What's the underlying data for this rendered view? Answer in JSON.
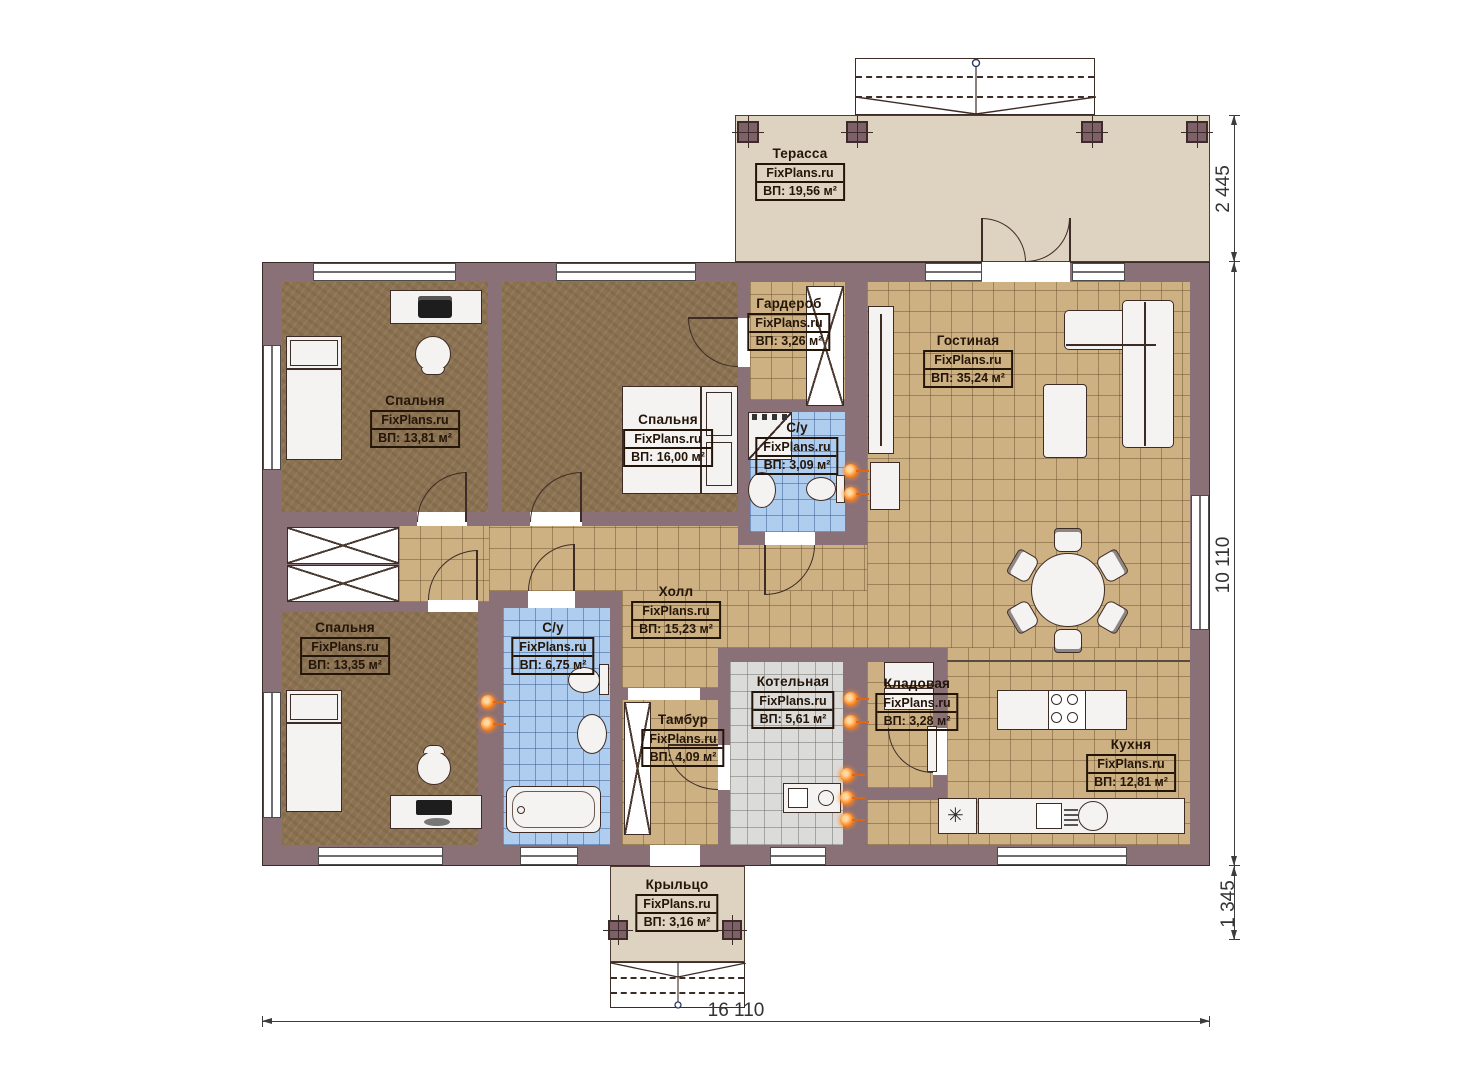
{
  "plan": {
    "watermark": "FixPlans.ru",
    "type_note": "single-storey house floor plan"
  },
  "rooms": [
    {
      "id": "terrace",
      "name": "Терасса",
      "area": "ВП: 19,56 м²"
    },
    {
      "id": "bedroom-top-left",
      "name": "Спальня",
      "area": "ВП: 13,81 м²"
    },
    {
      "id": "bedroom-middle",
      "name": "Спальня",
      "area": "ВП: 16,00 м²"
    },
    {
      "id": "wardrobe",
      "name": "Гардероб",
      "area": "ВП: 3,26 м²"
    },
    {
      "id": "bathroom-small",
      "name": "С/у",
      "area": "ВП: 3,09 м²"
    },
    {
      "id": "living-room",
      "name": "Гостиная",
      "area": "ВП: 35,24 м²"
    },
    {
      "id": "hall",
      "name": "Холл",
      "area": "ВП: 15,23 м²"
    },
    {
      "id": "bedroom-bottom-left",
      "name": "Спальня",
      "area": "ВП: 13,35 м²"
    },
    {
      "id": "bathroom-large",
      "name": "С/у",
      "area": "ВП: 6,75 м²"
    },
    {
      "id": "tambour",
      "name": "Тамбур",
      "area": "ВП: 4,09 м²"
    },
    {
      "id": "boiler-room",
      "name": "Котельная",
      "area": "ВП: 5,61 м²"
    },
    {
      "id": "pantry",
      "name": "Кладовая",
      "area": "ВП: 3,28 м²"
    },
    {
      "id": "kitchen",
      "name": "Кухня",
      "area": "ВП: 12,81 м²"
    },
    {
      "id": "porch",
      "name": "Крыльцо",
      "area": "ВП: 3,16 м²"
    }
  ],
  "dimensions": {
    "terrace_depth": "2 445",
    "house_depth": "10 110",
    "porch_depth": "1 345",
    "house_width": "16 110"
  },
  "icons": {
    "fridge_symbol": "✳"
  },
  "colors": {
    "wall": "#8a7077",
    "tile_floor": "#cdb183",
    "bedroom_floor": "#8b7252",
    "bathroom_floor": "#aecdef",
    "boiler_floor": "#dbdbd9",
    "terrace_floor": "#ded3c0",
    "radiator": "#ff8c2a",
    "label_text": "#241509"
  }
}
